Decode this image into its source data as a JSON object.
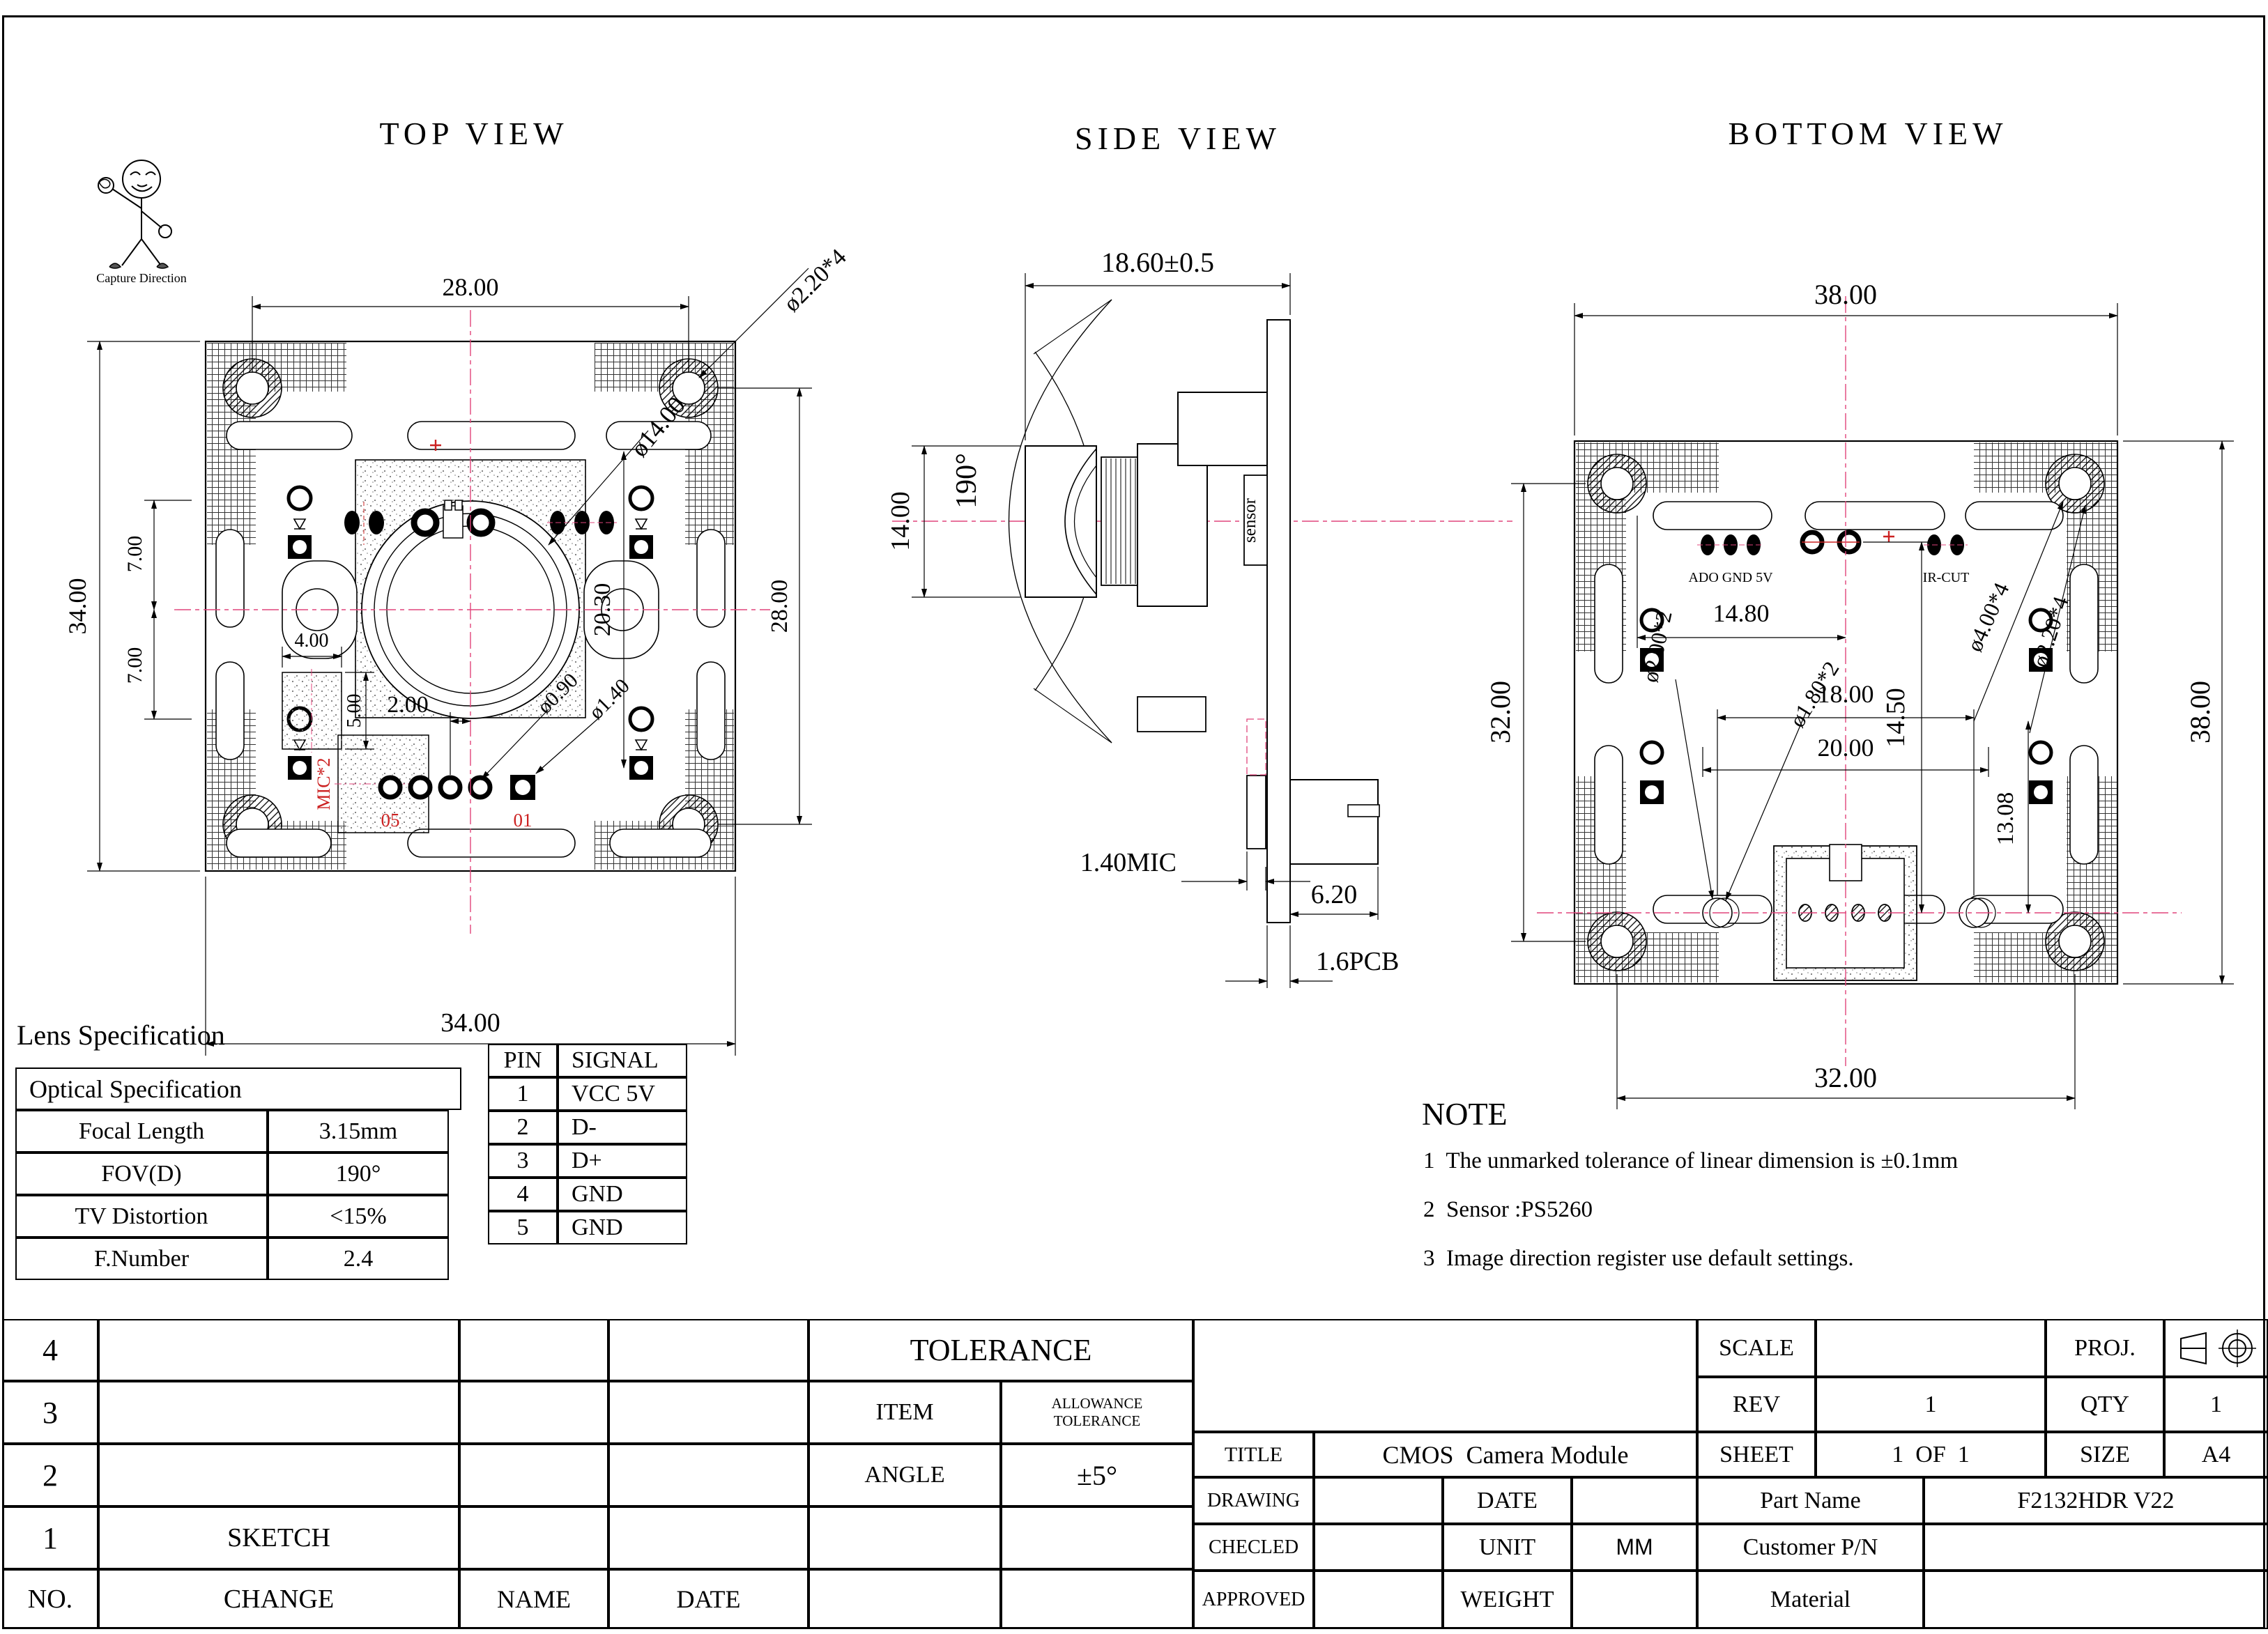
{
  "logo": {
    "caption": "Capture Direction"
  },
  "views": {
    "top": {
      "title": "TOP VIEW",
      "dims": {
        "width_top": "28.00",
        "corner_hole": "ø2.20*4",
        "height_left": "34.00",
        "upper_half": "7.00",
        "lower_half": "7.00",
        "lens_dia": "ø14.00",
        "inner_right": "20.30",
        "height_right": "28.00",
        "mic_width": "4.00",
        "mic_height": "5.00",
        "pad_offset": "2.00",
        "pad_hole_small": "ø0.90",
        "pad_hole_big": "ø1.40",
        "width_bottom": "34.00"
      },
      "labels": {
        "mic": "MIC*2",
        "pin5": "05",
        "pin1": "01"
      }
    },
    "side": {
      "title": "SIDE VIEW",
      "dims": {
        "total_length": "18.60±0.5",
        "lens_height": "14.00",
        "fov": "190°",
        "mic_thickness": "1.40MIC",
        "connector_depth": "6.20",
        "pcb_thickness": "1.6PCB"
      },
      "labels": {
        "sensor": "sensor"
      }
    },
    "bottom": {
      "title": "BOTTOM VIEW",
      "dims": {
        "width_top": "38.00",
        "pads_span": "14.80",
        "pad_drop": "14.50",
        "mid_hole": "ø2.00*2",
        "mid_hole2": "ø1.80*2",
        "corner_hole_outer": "ø4.00*4",
        "corner_hole_inner": "ø2.20*4",
        "mid_span": "18.00",
        "mid_span2": "20.00",
        "conn_offset": "13.08",
        "width_bottom": "32.00",
        "height_left": "32.00",
        "height_right": "38.00"
      },
      "labels": {
        "pads_left": "ADO GND  5V",
        "pads_right": "IR-CUT"
      }
    }
  },
  "lens_spec": {
    "heading": "Lens Specification",
    "table_title": "Optical Specification",
    "rows": [
      {
        "label": "Focal Length",
        "value": "3.15mm"
      },
      {
        "label": "FOV(D)",
        "value": "190°"
      },
      {
        "label": "TV Distortion",
        "value": "<15%"
      },
      {
        "label": "F.Number",
        "value": "2.4"
      }
    ]
  },
  "pin_table": {
    "headers": {
      "pin": "PIN",
      "signal": "SIGNAL"
    },
    "rows": [
      {
        "pin": "1",
        "signal": "VCC 5V"
      },
      {
        "pin": "2",
        "signal": "D-"
      },
      {
        "pin": "3",
        "signal": "D+"
      },
      {
        "pin": "4",
        "signal": "GND"
      },
      {
        "pin": "5",
        "signal": "GND"
      }
    ]
  },
  "note": {
    "heading": "NOTE",
    "items": [
      {
        "num": "1",
        "text": "The unmarked tolerance of linear dimension is ±0.1mm"
      },
      {
        "num": "2",
        "text": "Sensor :PS5260"
      },
      {
        "num": "3",
        "text": "Image direction register use default settings."
      }
    ]
  },
  "revision_table": {
    "row4": "4",
    "row3": "3",
    "row2": "2",
    "row1": "1",
    "no_label": "NO.",
    "sketch_label": "SKETCH",
    "change_label": "CHANGE",
    "name_label": "NAME",
    "date_label": "DATE",
    "tolerance_heading": "TOLERANCE",
    "item_label": "ITEM",
    "allowance_line1": "ALLOWANCE",
    "allowance_line2": "TOLERANCE",
    "angle_label": "ANGLE",
    "angle_value": "±5°"
  },
  "title_block": {
    "scale_label": "SCALE",
    "proj_label": "PROJ.",
    "rev_label": "REV",
    "rev_value": "1",
    "qty_label": "QTY",
    "qty_value": "1",
    "title_label": "TITLE",
    "title_value": "CMOS  Camera Module",
    "sheet_label": "SHEET",
    "sheet_value": "1  OF  1",
    "size_label": "SIZE",
    "size_value": "A4",
    "drawing_label": "DRAWING",
    "date_label": "DATE",
    "part_name_label": "Part Name",
    "part_name_value": "F2132HDR V22",
    "checked_label": "CHECLED",
    "unit_label": "UNIT",
    "unit_value": "MM",
    "customer_label": "Customer P/N",
    "approved_label": "APPROVED",
    "weight_label": "WEIGHT",
    "material_label": "Material"
  }
}
